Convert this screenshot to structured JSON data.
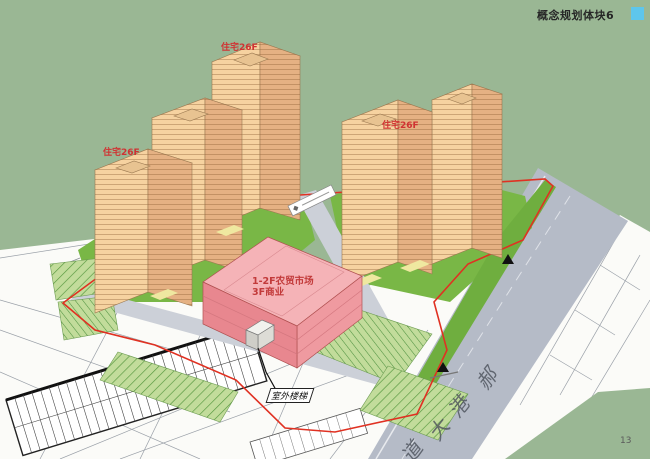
{
  "slide": {
    "title": "概念规划体块6",
    "page_number": "13"
  },
  "model": {
    "tower_labels": [
      {
        "text": "住宅26F"
      },
      {
        "text": "住宅26F"
      },
      {
        "text": "住宅26F"
      }
    ],
    "market_label_line1": "1-2F农贸市场",
    "market_label_line2": "3F商业",
    "stair_label": "室外楼梯",
    "road_name": "郝港大道",
    "road_name_chars": [
      "郝",
      "港",
      "大",
      "道"
    ]
  },
  "colors": {
    "background_green": "#9ab794",
    "title_swatch_blue": "#5ec6ec",
    "tower_light_face": "#f6d2a0",
    "tower_dark_face": "#e5b183",
    "tower_roof": "#f3d9ad",
    "market_pink_top": "#f5b3b7",
    "market_pink_face": "#ef9aa0",
    "lawn_green": "#79b746",
    "parking_green": "#c2dc9b",
    "road_gray": "#ccd0d8",
    "avenue_gray": "#b5bbc7",
    "boundary_red": "#e03122",
    "label_red": "#d03232",
    "plan_white": "#fbfbf8"
  }
}
